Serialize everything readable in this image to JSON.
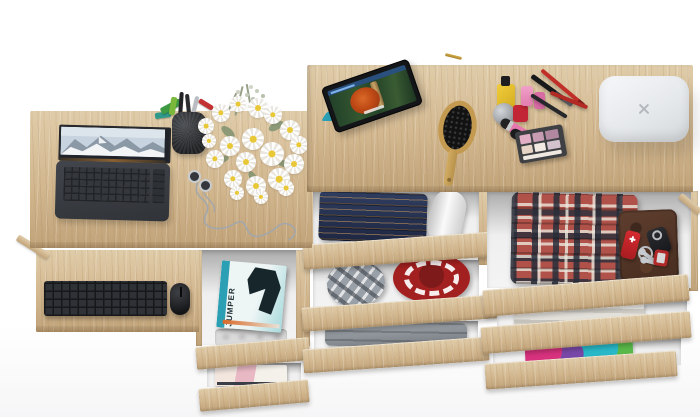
{
  "image": {
    "kind": "top-down 3D product render",
    "subject": "Light oak desk with pull-out keyboard shelf joined to a taller dresser unit with open drawers full of clothes and accessories",
    "background": "#ffffff"
  },
  "colors": {
    "wood": "#d2b78f",
    "wood-light": "#e0cca9",
    "wood-dark": "#c1a379",
    "interior": "#efefef",
    "interior-shadow": "#ababab",
    "laptop-body": "#3a3d41",
    "device-black": "#1c1d1f",
    "magazine-teal": "#2b9fb4",
    "jeans": "#26314e",
    "hat-red": "#a32020",
    "plaid-red": "#b0524a",
    "plaid-gray": "#9aa0a8",
    "wallet-brown": "#53362a",
    "cube-white": "#eef0f2",
    "flower-yellow": "#e9c838",
    "leaf-green": "#7f9070",
    "pink": "#e070a8",
    "knife-red": "#c8252a",
    "towel": "#dcd9d3",
    "magenta": "#d8327e",
    "teal": "#28b8c8"
  },
  "magazine": {
    "title": "JUMPER"
  },
  "labels": {
    "desk_left": "low oak desk top",
    "desk_right": "tall oak dresser top",
    "keyboard_shelf": "pull-out keyboard shelf",
    "laptop": "open laptop with mountain wallpaper",
    "keyboard": "black wireless keyboard",
    "mouse": "black mouse",
    "pen_cup": "mesh pen cup with pens",
    "flowers": "bouquet of white daisies",
    "earphones": "earphones with tangled cable",
    "tablet": "tablet playing an animated movie",
    "hairbrush": "wooden hairbrush",
    "cosmetics": "nail polish, perfume and lipstick",
    "palette": "eyeshadow palette",
    "smart_hub": "white smart hub with X logo",
    "hairpin": "gold hair pin",
    "jeans": "folded blue jeans",
    "paper_roll": "rolled paper",
    "flat_cap": "grey plaid flat cap",
    "red_hat": "red hat with white pattern",
    "grey_clothes": "folded grey clothes",
    "magazines": "stack of magazines",
    "organizer": "plastic organizer tray",
    "fashion_magazine": "fashion magazine",
    "plaid_shirts": "folded plaid shirts",
    "wallet": "brown leather wallet",
    "knife": "red pocket knife",
    "keys": "key ring with keys",
    "car_key": "car key fob",
    "key_tag": "red key tag",
    "towels": "folded towels",
    "colorful_clothes": "colourful folded clothes",
    "drawer_front": "oak drawer front"
  }
}
